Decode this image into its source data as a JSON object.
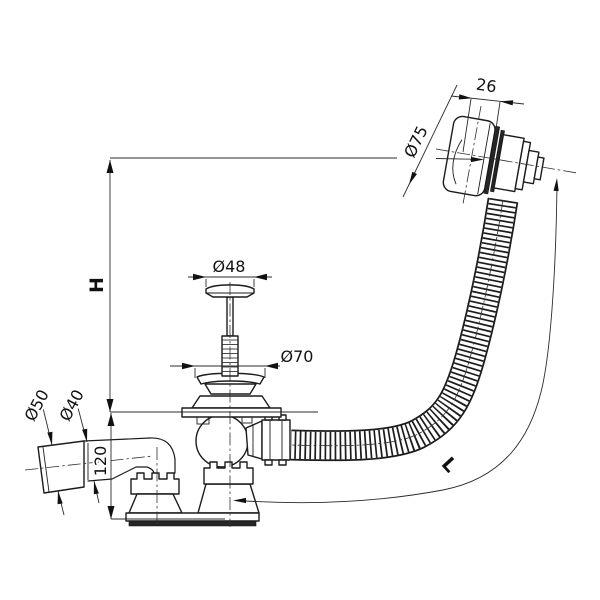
{
  "dimensions": {
    "overflow_width": "26",
    "overflow_cap_diameter": "Ø75",
    "plug_diameter": "Ø48",
    "drain_flange_diameter": "Ø70",
    "outlet_socket_diameter": "Ø50",
    "outlet_pipe_diameter": "Ø40",
    "trap_height": "120",
    "height_label": "H",
    "hose_length_label": "L"
  },
  "watermark": {
    "text": "alca"
  },
  "colors": {
    "background": "#ffffff",
    "outline": "#1c1c1c",
    "dimension_line": "#2b2b2b",
    "gasket_fill": "#262626",
    "base_fill": "#111111",
    "watermark": "#cccccc"
  }
}
